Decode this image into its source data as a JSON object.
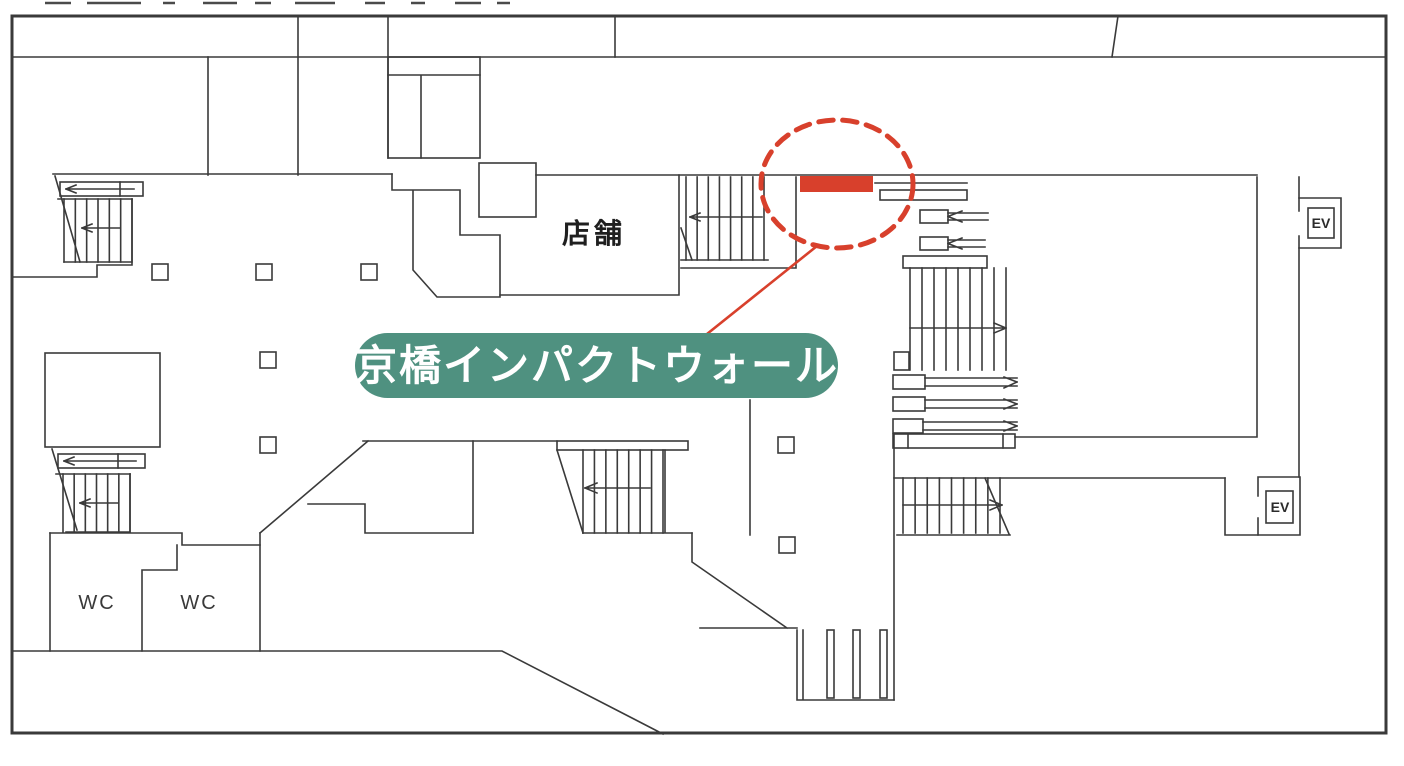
{
  "page": {
    "background": "#FFFFFF"
  },
  "colors": {
    "line": "#3A3A3A",
    "accent_red": "#D8402C",
    "pill_green": "#4F9180",
    "label_text": "#FFFFFF"
  },
  "plan": {
    "shop_label": "店舗",
    "wc_labels": [
      "WC",
      "WC"
    ],
    "ev_labels": [
      "EV",
      "EV"
    ]
  },
  "callout": {
    "label": "京橋インパクトウォール",
    "pill_color": "#4F9180",
    "text_color": "#FFFFFF",
    "highlight_color": "#D8402C"
  }
}
